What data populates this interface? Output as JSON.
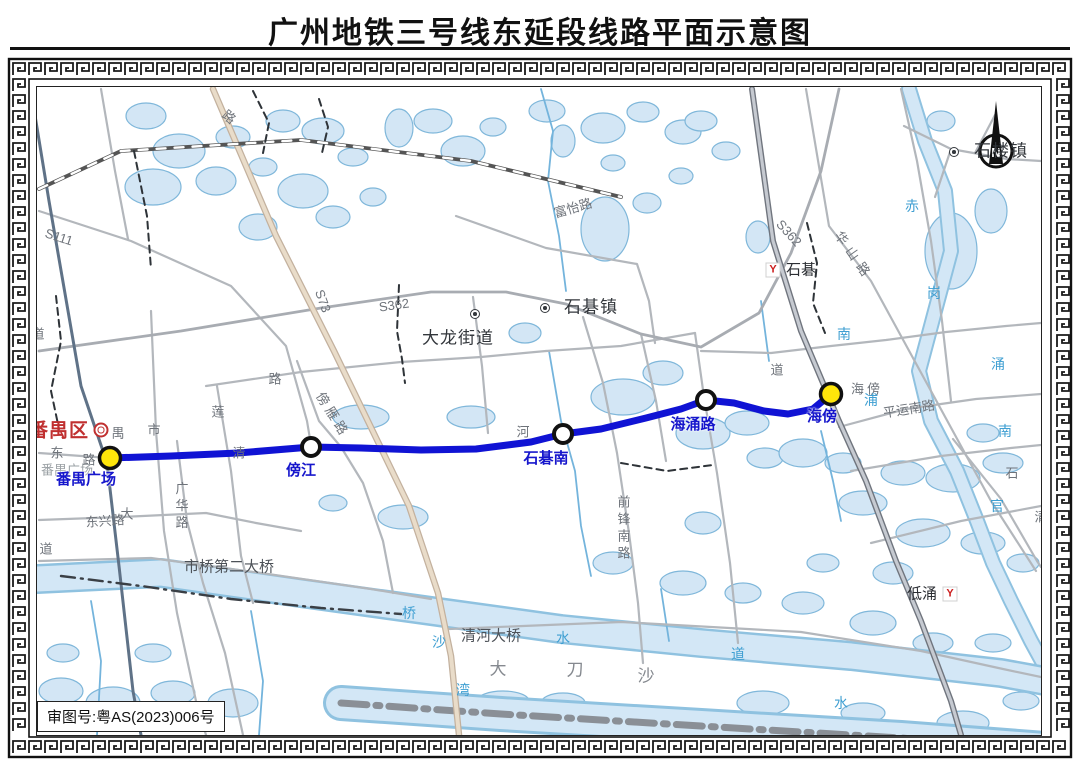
{
  "title": "广州地铁三号线东延段线路平面示意图",
  "approval_note": "审图号:粤AS(2023)006号",
  "north_indicator": "N",
  "metro_line": {
    "name": "三号线东延段",
    "color": "#1013d4",
    "path": [
      [
        109,
        457
      ],
      [
        170,
        455
      ],
      [
        237,
        452
      ],
      [
        310,
        446
      ],
      [
        360,
        447
      ],
      [
        420,
        449
      ],
      [
        475,
        448
      ],
      [
        530,
        441
      ],
      [
        562,
        433
      ],
      [
        600,
        428
      ],
      [
        645,
        417
      ],
      [
        680,
        408
      ],
      [
        705,
        399
      ],
      [
        733,
        402
      ],
      [
        763,
        410
      ],
      [
        787,
        413
      ],
      [
        812,
        408
      ],
      [
        830,
        393
      ]
    ],
    "stations": [
      {
        "name": "番禺广场",
        "x": 109,
        "y": 457,
        "terminal": true,
        "lx": 85,
        "ly": 471
      },
      {
        "name": "傍江",
        "x": 310,
        "y": 446,
        "terminal": false,
        "lx": 300,
        "ly": 462
      },
      {
        "name": "石碁南",
        "x": 562,
        "y": 433,
        "terminal": false,
        "lx": 545,
        "ly": 450
      },
      {
        "name": "海涌路",
        "x": 705,
        "y": 399,
        "terminal": false,
        "lx": 692,
        "ly": 416
      },
      {
        "name": "海傍",
        "x": 830,
        "y": 393,
        "terminal": true,
        "lx": 821,
        "ly": 408
      }
    ]
  },
  "other_metro_stations": [
    {
      "name": "石碁",
      "logo": "Y",
      "sx": 772,
      "sy": 269,
      "tx": 800,
      "ty": 269
    },
    {
      "name": "低涌",
      "logo": "Y",
      "sx": 949,
      "sy": 593,
      "tx": 921,
      "ty": 593
    }
  ],
  "towns": [
    {
      "name": "大龙街道",
      "sx": 476,
      "sy": 313,
      "tx": 457,
      "ty": 337
    },
    {
      "name": "石碁镇",
      "sx": 546,
      "sy": 307,
      "tx": 590,
      "ty": 306
    },
    {
      "name": "石楼镇",
      "sx": 955,
      "sy": 151,
      "tx": 1000,
      "ty": 150
    }
  ],
  "district": {
    "name": "番禺区",
    "sx": 100,
    "sy": 431,
    "tx": 58,
    "ty": 430
  },
  "labels": [
    {
      "t": "S111",
      "x": 58,
      "y": 236,
      "c": "road",
      "r": 18
    },
    {
      "t": "S362",
      "x": 393,
      "y": 304,
      "c": "road",
      "r": -8
    },
    {
      "t": "S362",
      "x": 788,
      "y": 232,
      "c": "road",
      "r": 48
    },
    {
      "t": "S73",
      "x": 322,
      "y": 300,
      "c": "road",
      "r": 70
    },
    {
      "t": "富怡路",
      "x": 572,
      "y": 207,
      "c": "road",
      "r": -16
    },
    {
      "t": "华山路",
      "x": 853,
      "y": 255,
      "c": "road",
      "r": 55,
      "ls": 6
    },
    {
      "t": "平运南路",
      "x": 908,
      "y": 408,
      "c": "road",
      "r": -9
    },
    {
      "t": "傍雁路",
      "x": 332,
      "y": 414,
      "c": "road",
      "r": 58,
      "ls": 4
    },
    {
      "t": "广华路",
      "x": 180,
      "y": 506,
      "c": "road",
      "v": 1
    },
    {
      "t": "前锋南路",
      "x": 622,
      "y": 528,
      "c": "road",
      "v": 1
    },
    {
      "t": "东兴路",
      "x": 104,
      "y": 520,
      "c": "road",
      "r": -4
    },
    {
      "t": "大",
      "x": 126,
      "y": 513,
      "c": "road"
    },
    {
      "t": "东",
      "x": 56,
      "y": 452,
      "c": "road"
    },
    {
      "t": "路",
      "x": 88,
      "y": 459,
      "c": "road"
    },
    {
      "t": "禺",
      "x": 117,
      "y": 432,
      "c": "road"
    },
    {
      "t": "市",
      "x": 153,
      "y": 429,
      "c": "road"
    },
    {
      "t": "清",
      "x": 238,
      "y": 452,
      "c": "road"
    },
    {
      "t": "河",
      "x": 522,
      "y": 431,
      "c": "road"
    },
    {
      "t": "道",
      "x": 37,
      "y": 333,
      "c": "road"
    },
    {
      "t": "道",
      "x": 45,
      "y": 548,
      "c": "road"
    },
    {
      "t": "莲",
      "x": 217,
      "y": 411,
      "c": "road"
    },
    {
      "t": "路",
      "x": 228,
      "y": 116,
      "c": "road",
      "r": 40
    },
    {
      "t": "路",
      "x": 274,
      "y": 378,
      "c": "road"
    },
    {
      "t": "海傍",
      "x": 866,
      "y": 388,
      "c": "road",
      "ls": 3
    },
    {
      "t": "道",
      "x": 776,
      "y": 369,
      "c": "road"
    },
    {
      "t": "石",
      "x": 1011,
      "y": 472,
      "c": "road"
    },
    {
      "t": "清",
      "x": 1040,
      "y": 516,
      "c": "road"
    },
    {
      "t": "市桥第二大桥",
      "x": 228,
      "y": 566,
      "c": "bridge"
    },
    {
      "t": "清河大桥",
      "x": 490,
      "y": 635,
      "c": "bridge"
    },
    {
      "t": "大",
      "x": 497,
      "y": 668,
      "c": "island"
    },
    {
      "t": "刀",
      "x": 574,
      "y": 669,
      "c": "island"
    },
    {
      "t": "沙",
      "x": 645,
      "y": 675,
      "c": "island"
    },
    {
      "t": "番禺广场",
      "x": 66,
      "y": 469,
      "c": "area"
    },
    {
      "t": "赤",
      "x": 911,
      "y": 205,
      "c": "water"
    },
    {
      "t": "岗",
      "x": 933,
      "y": 292,
      "c": "water"
    },
    {
      "t": "涌",
      "x": 997,
      "y": 363,
      "c": "water"
    },
    {
      "t": "南",
      "x": 843,
      "y": 333,
      "c": "water"
    },
    {
      "t": "浦",
      "x": 870,
      "y": 399,
      "c": "water"
    },
    {
      "t": "南",
      "x": 1004,
      "y": 430,
      "c": "water"
    },
    {
      "t": "官",
      "x": 996,
      "y": 505,
      "c": "water"
    },
    {
      "t": "桥",
      "x": 408,
      "y": 612,
      "c": "water"
    },
    {
      "t": "沙",
      "x": 438,
      "y": 641,
      "c": "water"
    },
    {
      "t": "水",
      "x": 562,
      "y": 637,
      "c": "water"
    },
    {
      "t": "道",
      "x": 737,
      "y": 653,
      "c": "water"
    },
    {
      "t": "湾",
      "x": 462,
      "y": 689,
      "c": "water"
    },
    {
      "t": "水",
      "x": 840,
      "y": 702,
      "c": "water"
    }
  ]
}
